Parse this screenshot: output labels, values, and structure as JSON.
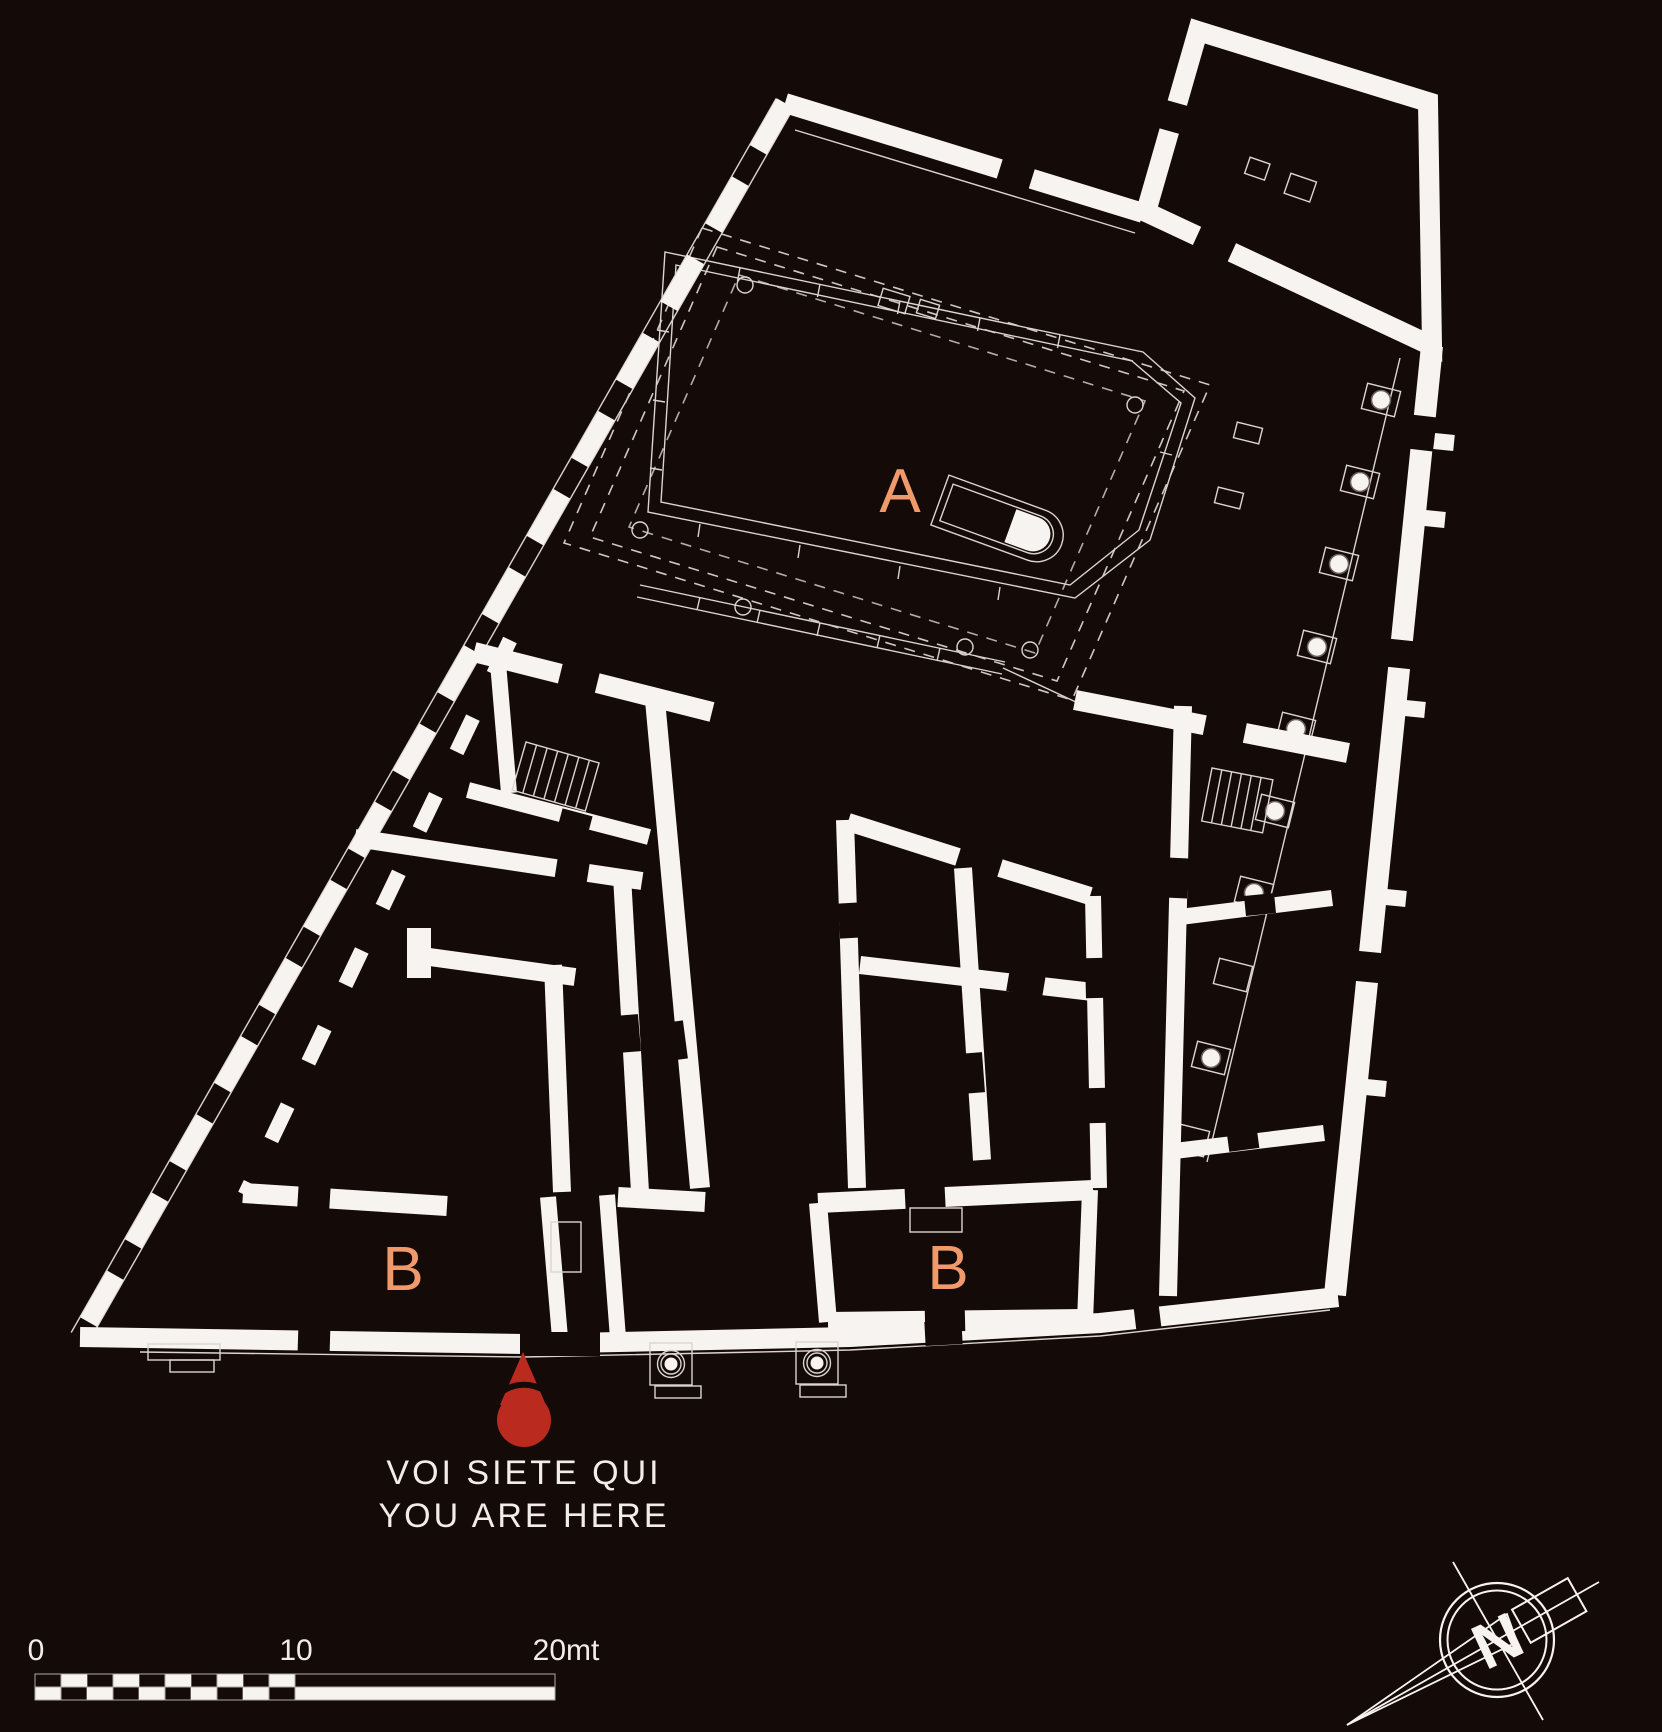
{
  "map": {
    "background_color": "#140b09",
    "wall_color": "#f7f3f0",
    "accent_color": "#f09a6c",
    "marker_color": "#bb2a1e",
    "areas": [
      {
        "id": "temple-court",
        "label": "A"
      },
      {
        "id": "shops-west",
        "label": "B"
      },
      {
        "id": "shops-east",
        "label": "B"
      }
    ],
    "you_are_here": {
      "line1": "VOI SIETE QUI",
      "line2": "YOU ARE HERE",
      "icon": "you-are-here-pin-icon"
    },
    "scale_bar": {
      "tick0": "0",
      "tick10": "10",
      "tick20": "20mt",
      "units": "mt"
    },
    "compass": {
      "letter": "N",
      "icon": "north-compass-icon"
    }
  }
}
